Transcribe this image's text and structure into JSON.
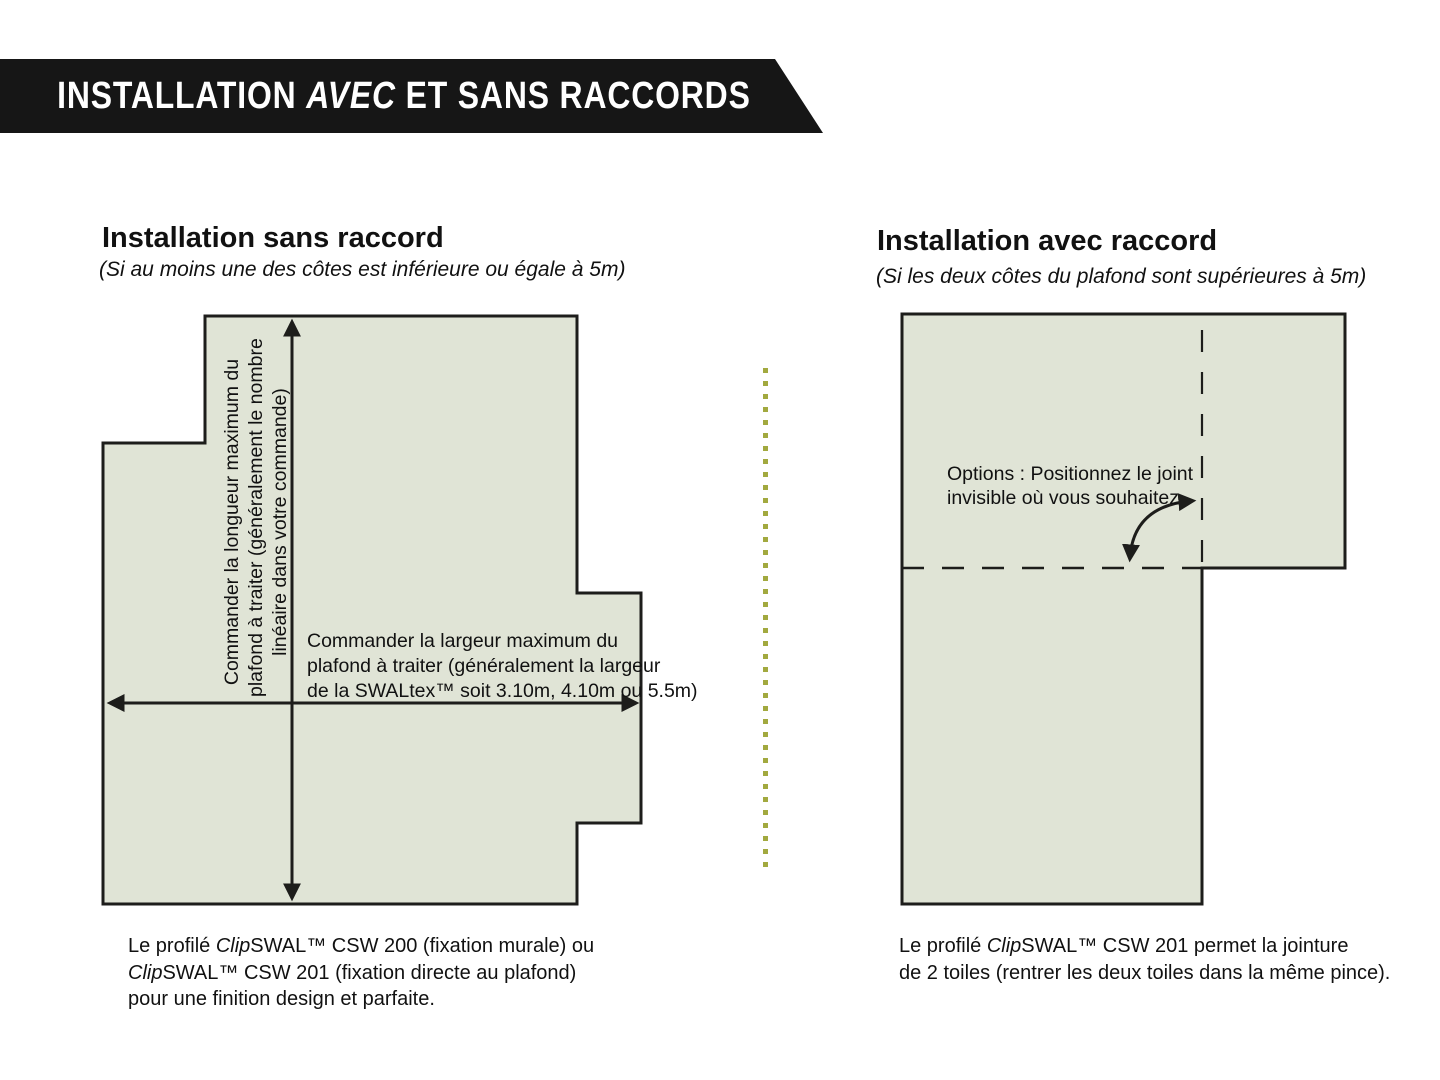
{
  "banner": {
    "title_runs": [
      {
        "t": "INSTALLATION "
      },
      {
        "t": "AVEC",
        "i": true
      },
      {
        "t": " ET SANS RACCORDS"
      }
    ]
  },
  "left_panel": {
    "heading": "Installation sans raccord",
    "subtitle": "(Si au moins une des côtes est inférieure ou égale à 5m)",
    "length_label_lines": [
      "Commander la longueur maximum du",
      "plafond à traiter (généralement le nombre",
      "linéaire dans votre commande)"
    ],
    "width_label_lines": [
      "Commander la largeur maximum du",
      "plafond à traiter (généralement la largeur",
      "de la SWALtex™ soit 3.10m, 4.10m ou 5.5m)"
    ],
    "caption_lines_runs": [
      [
        {
          "t": "Le profilé "
        },
        {
          "t": "Clip",
          "i": true
        },
        {
          "t": "SWAL"
        },
        {
          "t": "™ CSW 200 (fixation murale) ou"
        }
      ],
      [
        {
          "t": "Clip",
          "i": true
        },
        {
          "t": "SWAL"
        },
        {
          "t": "™ CSW 201 (fixation directe au plafond)"
        }
      ],
      [
        {
          "t": "pour une finition design et parfaite."
        }
      ]
    ]
  },
  "right_panel": {
    "heading": "Installation avec raccord",
    "subtitle": "(Si les deux côtes du plafond sont supérieures à 5m)",
    "options_label_lines": [
      "Options : Positionnez le joint",
      "invisible où vous souhaitez"
    ],
    "caption_lines_runs": [
      [
        {
          "t": "Le profilé "
        },
        {
          "t": "Clip",
          "i": true
        },
        {
          "t": "SWAL"
        },
        {
          "t": "™ CSW 201 permet la jointure"
        }
      ],
      [
        {
          "t": "de 2 toiles (rentrer les deux toiles dans la même pince)."
        }
      ]
    ]
  },
  "colors": {
    "banner_bg": "#161616",
    "banner_text": "#ffffff",
    "shape_fill": "#e0e4d6",
    "shape_border": "#1d1d1b",
    "arrow": "#1d1d1b",
    "joint_dash": "#1d1d1b",
    "separator_dot": "#a2a93f",
    "text": "#111111"
  }
}
